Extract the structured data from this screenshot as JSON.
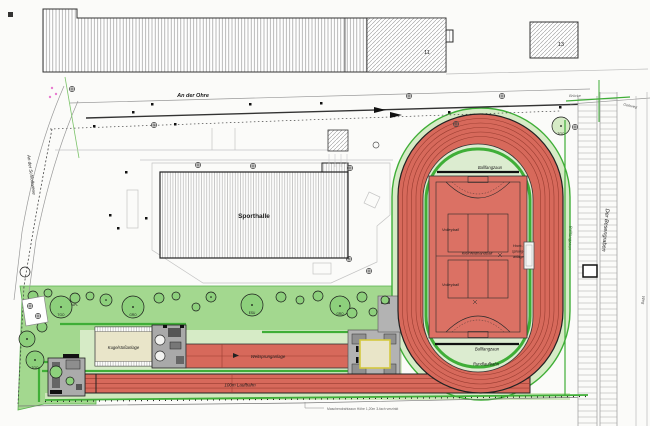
{
  "plan": {
    "streets": {
      "top": "An der Ohre",
      "left": "An der Schloßwiese",
      "bridge": "Brücke",
      "footway": "Gehweg",
      "path": "Weg",
      "ditch": "Der Besengraben"
    },
    "buildings": {
      "sporthalle": "Sporthalle",
      "no11": "11",
      "no13": "13"
    },
    "stadium": {
      "fence_top": "Ballfangzaun",
      "fence_bottom": "Ballfangzaun",
      "fence_right": "Ballfangzaun",
      "round_track": "Rundlaufbahn",
      "volleyball_upper": "Volleyball",
      "volleyball_lower": "Volleyball",
      "handball": "Kleinfeldhandball",
      "highjump_line1": "Hoch-",
      "highjump_line2": "sprung-",
      "highjump_line3": "anlage"
    },
    "athletics": {
      "shotput": "Kugelstoßanlage",
      "longjump": "Weitsprunganlage",
      "sprint": "100m Laufbahn"
    },
    "note_fence": "Maschendrahtzaun Höhe 1,20m 3-fach verzinkt",
    "tree_codes": {
      "c0": "TGO",
      "c1": "APL",
      "c2": "GRO",
      "c3": "ESU"
    },
    "colors": {
      "track_red": "#d7695b",
      "court_red": "#db7164",
      "lane_line": "#993c30",
      "green_strip": "#a3d88f",
      "pale_green": "#d6ebc6",
      "infield": "#dcecd0",
      "hedge_green": "#3fae37",
      "sand": "#e9e5c8",
      "sand_border": "#d4c93e",
      "building_gray": "#a9a9a9"
    }
  }
}
